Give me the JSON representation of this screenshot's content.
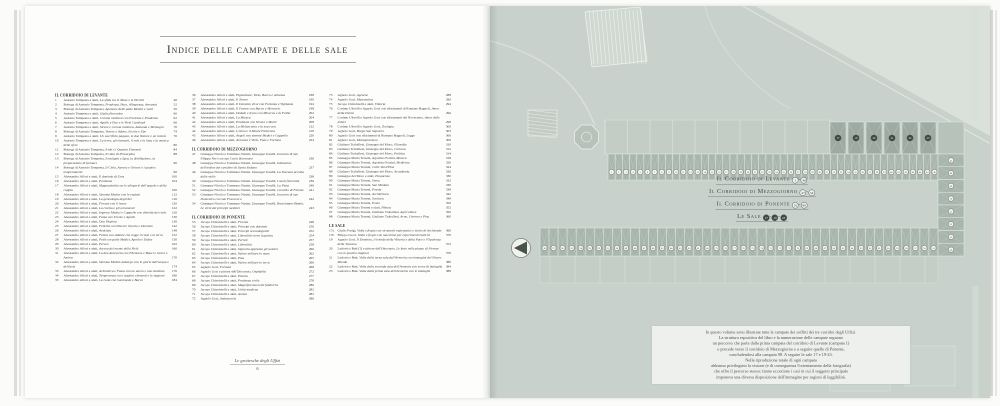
{
  "header": {
    "title": "Indice delle campate e delle sale"
  },
  "footer": {
    "book_title": "Le grottesche degli Uffizi",
    "page_number": "6"
  },
  "index": {
    "columns": [
      [
        {
          "h": "IL CORRIDOIO DI LEVANTE"
        },
        {
          "n": "1",
          "a": "Antonio Tempesta e aiuti,",
          "t": "La sfida tra le Muse e le Pieridi",
          "p": "46"
        },
        {
          "n": "2",
          "a": "Bottega di Antonio Tempesta,",
          "t": "Prudenza, Pace, Allegrezza, Armonia",
          "p": "52"
        },
        {
          "n": "3",
          "a": "Bottega di Antonio Tempesta,",
          "t": "Apoteosi delle palle Medici e venti",
          "p": "56"
        },
        {
          "n": "4",
          "a": "Antonio Tempesta e aiuti,",
          "t": "Giglio fiorentino",
          "p": "60"
        },
        {
          "n": "5",
          "a": "Antonio Tempesta e aiuti,",
          "t": "Corona medicea con Fortezza e Prudenza",
          "p": "62"
        },
        {
          "n": "6",
          "a": "Antonio Tempesta e aiuti,",
          "t": "Apollo e Pan e le Virtù Cardinali",
          "p": "66"
        },
        {
          "n": "7",
          "a": "Antonio Tempesta e aiuti,",
          "t": "Sirene e corona medicea, Atalanta e Meleagro",
          "p": "70"
        },
        {
          "n": "8",
          "a": "Bottega di Antonio Tempesta,",
          "t": "Venere e Adone, Ercole e Ebe",
          "p": "74"
        },
        {
          "n": "9",
          "a": "Antonio Tempesta e aiuti,",
          "t": "Un sacrificio pagano, le due Nature e un tralcio",
          "p": "76"
        },
        {
          "n": "10",
          "a": "Antonio Tempesta e aiuti,",
          "t": "La terra, gli elementi, il sole e la luna e la musica delle sfere",
          "p": "80"
        },
        {
          "n": "11",
          "a": "Bottega di Antonio Tempesta,",
          "t": "Iride e i Quattro Elementi",
          "p": "84"
        },
        {
          "n": "12",
          "a": "Bottega di Antonio Tempesta,",
          "t": "Il ratto di Proserpina",
          "p": "88"
        },
        {
          "n": "13",
          "a": "Bottega di Antonio Tempesta,",
          "t": "Esculapio e Igea, la distillazione, la preparazione di farmaci",
          "p": "90"
        },
        {
          "n": "14",
          "a": "Bottega di Antonio Tempesta,",
          "t": "Il Cielo, Aurora e Orione e i quattro temperamenti",
          "p": "96"
        },
        {
          "n": "15",
          "a": "Alessandro Allori e aiuti,",
          "t": "Il dominio di Eros",
          "p": "100"
        },
        {
          "n": "16",
          "a": "Alessandro Allori e aiuti,",
          "t": "Prudenza",
          "p": "104"
        },
        {
          "n": "17",
          "a": "Alessandro Allori e aiuti,",
          "t": "Magnanimità con le allegorie dell'angolo e della coppia",
          "p": "106"
        },
        {
          "n": "18",
          "a": "Alessandro Allori e aiuti,",
          "t": "Stemma Medici con le regioni",
          "p": "112"
        },
        {
          "n": "19",
          "a": "Alessandro Allori e aiuti,",
          "t": "La genealogia degli dei",
          "p": "116"
        },
        {
          "n": "20",
          "a": "Alessandro Allori e aiuti,",
          "t": "Firenze con il leone",
          "p": "120"
        },
        {
          "n": "21",
          "a": "Alessandro Allori e aiuti,",
          "t": "La civetta e gli ornamenti",
          "p": "122"
        },
        {
          "n": "22",
          "a": "Alessandro Allori e aiuti,",
          "t": "Imprese Medici e Cappello con divinità del cielo",
          "p": "126"
        },
        {
          "n": "23",
          "a": "Alessandro Allori e aiuti,",
          "t": "Fama con Ercole e Apollo",
          "p": "130"
        },
        {
          "n": "24",
          "a": "Alessandro Allori e aiuti,",
          "t": "Dea Virginia",
          "p": "136"
        },
        {
          "n": "25",
          "a": "Alessandro Allori e aiuti,",
          "t": "Felicità con Piacere Onesto e Dionisio",
          "p": "142"
        },
        {
          "n": "26",
          "a": "Alessandro Allori e aiuti,",
          "t": "Amicizia",
          "p": "148"
        },
        {
          "n": "27",
          "a": "Alessandro Allori e aiuti,",
          "t": "Fatica con Atlante che regge il cielo e la terra",
          "p": "152"
        },
        {
          "n": "28",
          "a": "Alessandro Allori e aiuti,",
          "t": "Putti con palle Medici, Apollo e Dafne",
          "p": "156"
        },
        {
          "n": "29",
          "a": "Alessandro Allori e aiuti,",
          "t": "Perseo",
          "p": "162"
        },
        {
          "n": "30",
          "a": "Alessandro Allori e aiuti,",
          "t": "Ascesa del monte della Virtù",
          "p": "166"
        },
        {
          "n": "31",
          "a": "Alessandro Allori e aiuti,",
          "t": "La dea Anteverta con Filemone e Bauci e Giove e Ambra",
          "p": "170"
        },
        {
          "n": "32",
          "a": "Alessandro Allori e aiuti,",
          "t": "Stemma Medici-Asburgo con le glorie dell'acqua e dell'aria",
          "p": "174"
        },
        {
          "n": "33",
          "a": "Alessandro Allori e aiuti,",
          "t": "Aritmetica e Fama con un aureo e uno studioso",
          "p": "176"
        },
        {
          "n": "34",
          "a": "Alessandro Allori e aiuti,",
          "t": "Temperanza con i quattro elementi e le stagioni",
          "p": "180"
        },
        {
          "n": "35",
          "a": "Alessandro Allori e aiuti,",
          "t": "La Gola con Ganimede e Bacco",
          "p": "184"
        }
      ],
      [
        {
          "n": "36",
          "a": "Alessandro Allori e aiuti,",
          "t": "Pigmalione, Tizio, Bacco e Arianna",
          "p": "188"
        },
        {
          "n": "37",
          "a": "Alessandro Allori e aiuti,",
          "t": "Il Tevere",
          "p": "190"
        },
        {
          "n": "38",
          "a": "Alessandro Allori e aiuti,",
          "t": "Il Dominio di sé con Fortezza e Vigilanza",
          "p": "194"
        },
        {
          "n": "39",
          "a": "Alessandro Allori e aiuti,",
          "t": "Il Favore con Bacco e Mercurio",
          "p": "198"
        },
        {
          "n": "40",
          "a": "Alessandro Allori e aiuti,",
          "t": "Dedalo e Icaro con Minerva e la Follia",
          "p": "202"
        },
        {
          "n": "41",
          "a": "Alessandro Allori e aiuti,",
          "t": "La Musica",
          "p": "204"
        },
        {
          "n": "42",
          "a": "Alessandro Allori e aiuti,",
          "t": "Prudenza con Venere e Marte",
          "p": "208"
        },
        {
          "n": "43",
          "a": "Alessandro Allori e aiuti,",
          "t": "La Melanconia e la sua cura",
          "p": "212"
        },
        {
          "n": "44",
          "a": "Alessandro Allori e aiuti,",
          "t": "L'Arno e il Monte Falterona",
          "p": "219"
        },
        {
          "n": "45",
          "a": "Alessandro Allori e aiuti,",
          "t": "Angeli con stemmi Medici e Cappello",
          "p": "220"
        },
        {
          "n": "46",
          "a": "Alessandro Allori e aiuti,",
          "t": "Armonia e Virtù, Fato e Fortuna",
          "p": "224"
        },
        {
          "h": "IL CORRIDOIO DI MEZZOGIORNO"
        },
        {
          "n": "47",
          "a": "Giuseppe Nicola e Tommaso Nasini, Giuseppe Tonelli,",
          "t": "Incontro di san Filippo Neri con san Carlo Borromeo",
          "p": "236"
        },
        {
          "n": "48",
          "a": "Giuseppe Nicola e Tommaso Nasini, Giuseppe Tonelli,",
          "t": "Istituzione dell'ordine dei cavalieri di Santo Stefano",
          "p": "237"
        },
        {
          "n": "49",
          "a": "Giuseppe Nicola e Tommaso Nasini, Giuseppe Tonelli,",
          "t": "La Toscana accolta dalle stelle",
          "p": "238"
        },
        {
          "n": "50",
          "a": "Giuseppe Nicola e Tommaso Nasini, Giuseppe Tonelli,",
          "t": "I santi fiorentini",
          "p": "239"
        },
        {
          "n": "51",
          "a": "Giuseppe Nicola e Tommaso Nasini, Giuseppe Tonelli,",
          "t": "La Pietà",
          "p": "240"
        },
        {
          "n": "52",
          "a": "Giuseppe Nicola e Tommaso Nasini, Giuseppe Tonelli,",
          "t": "Concilio di Firenze",
          "p": "241"
        },
        {
          "n": "53",
          "a": "Giuseppe Nicola e Tommaso Nasini, Giuseppe Tonelli,",
          "t": "Incontro di san Domenico con san Francesco",
          "p": "242"
        },
        {
          "n": "54",
          "a": "Giuseppe Nicola e Tommaso Nasini, Giuseppe Tonelli, Bartolomeo Bimbi,",
          "t": "Le virtù dei principi medicei",
          "p": "243"
        },
        {
          "h": "IL CORRIDOIO DI PONENTE"
        },
        {
          "n": "55",
          "a": "Jacopo Chiavistelli e aiuti,",
          "t": "Firenze",
          "p": "248"
        },
        {
          "n": "56",
          "a": "Jacopo Chiavistelli e aiuti,",
          "t": "Principi con dominio",
          "p": "250"
        },
        {
          "n": "57",
          "a": "Jacopo Chiavistelli e aiuti,",
          "t": "Principi secondogeniti",
          "p": "252"
        },
        {
          "n": "58",
          "a": "Jacopo Chiavistelli e aiuti,",
          "t": "Liberalità verso la patria",
          "p": "254"
        },
        {
          "n": "59",
          "a": "Jacopo Chiavistelli e aiuti,",
          "t": "Pericle",
          "p": "257"
        },
        {
          "n": "60",
          "a": "Jacopo Chiavistelli e aiuti,",
          "t": "Liberalità",
          "p": "258"
        },
        {
          "n": "61",
          "a": "Jacopo Chiavistelli e aiuti,",
          "t": "Signoria apprezza gli uomini",
          "p": "260"
        },
        {
          "n": "62",
          "a": "Jacopo Chiavistelli e aiuti,",
          "t": "Valore militare in mare",
          "p": "262"
        },
        {
          "n": "63",
          "a": "Jacopo Chiavistelli e aiuti,",
          "t": "Pisa",
          "p": "265"
        },
        {
          "n": "64",
          "a": "Jacopo Chiavistelli e aiuti,",
          "t": "Valore militare in terra",
          "p": "266"
        },
        {
          "n": "65",
          "a": "Agnolo Gori,",
          "t": "Fortuna",
          "p": "268"
        },
        {
          "n": "66",
          "a": "Agnolo Gori e pittore dell'Ottocento,",
          "t": "Ospitalità",
          "p": "272"
        },
        {
          "n": "67",
          "a": "Jacopo Chiavistelli e aiuti,",
          "t": "Pistoia",
          "p": "277"
        },
        {
          "n": "68",
          "a": "Jacopo Chiavistelli e aiuti,",
          "t": "Prudenza civile",
          "p": "278"
        },
        {
          "n": "69",
          "a": "Jacopo Chiavistelli e aiuti,",
          "t": "Magnificenza nelle fabbriche",
          "p": "280"
        },
        {
          "n": "70",
          "a": "Jacopo Chiavistelli e aiuti,",
          "t": "Unità medicea",
          "p": "282"
        },
        {
          "n": "71",
          "a": "Jacopo Chiavistelli e aiuti,",
          "t": "Arezzo",
          "p": "285"
        },
        {
          "n": "72",
          "a": "Agnolo Gori,",
          "t": "Ambasceria",
          "p": "286"
        }
      ],
      [
        {
          "n": "73",
          "a": "Agnolo Gori,",
          "t": "Agraria",
          "p": "288"
        },
        {
          "n": "74",
          "a": "Agnolo Gori,",
          "t": "Matematica",
          "p": "290"
        },
        {
          "n": "75",
          "a": "Jacopo Chiavistelli e aiuti,",
          "t": "Vittoria",
          "p": "294"
        },
        {
          "n": "76",
          "a": "Cosimo Ulivelli e Agnolo Gori con rifacimenti di Romano Bagnoli,",
          "t": "Amor della Patria",
          "p": "296"
        },
        {
          "n": "77",
          "a": "Cosimo Ulivelli e Agnolo Gori con rifacimenti del Novecento,",
          "t": "Amor delle lettere",
          "p": "298"
        },
        {
          "n": "78",
          "a": "Cosimo Ulivelli e Agnolo Gori,",
          "t": "Teologia",
          "p": "300"
        },
        {
          "n": "79",
          "a": "Agnolo Gori,",
          "t": "Borgo San Sepolcro",
          "p": "303"
        },
        {
          "n": "80",
          "a": "Agnolo Gori con rifacimenti di Romano Bagnoli,",
          "t": "Legge",
          "p": "306"
        },
        {
          "n": "81",
          "a": "Agnolo Gori,",
          "t": "Montepulciano",
          "p": "309"
        },
        {
          "n": "82",
          "a": "Giuliano Traballesi, Giuseppe del Moro,",
          "t": "Filosofia",
          "p": "310"
        },
        {
          "n": "83",
          "a": "Giuliano Traballesi, Giuseppe del Moro,",
          "t": "Cortona",
          "p": "312"
        },
        {
          "n": "84",
          "a": "Giuliano Traballesi, Giuseppe del Moro,",
          "t": "Politica",
          "p": "314"
        },
        {
          "n": "85",
          "a": "Giuseppe Maria Terreni, Agostino Fortini,",
          "t": "Musica",
          "p": "318"
        },
        {
          "n": "86",
          "a": "Giuseppe Maria Terreni, Agostino Fortini,",
          "t": "Medicina",
          "p": "320"
        },
        {
          "n": "87",
          "a": "Giuseppe Maria Terreni,",
          "t": "Colle Val d'Elsa",
          "p": "324"
        },
        {
          "n": "88",
          "a": "Giuliano Traballesi, Giuseppe del Moro,",
          "t": "Accademia",
          "p": "326"
        },
        {
          "n": "89",
          "a": "Giuseppe del Moro e aiuti,",
          "t": "Eloquenza",
          "p": "330"
        },
        {
          "n": "90",
          "a": "Giuseppe Maria Terreni,",
          "t": "Siena",
          "p": "332"
        },
        {
          "n": "91",
          "a": "Giuseppe Maria Terreni,",
          "t": "San Miniato",
          "p": "336"
        },
        {
          "n": "92",
          "a": "Giuseppe Maria Terreni,",
          "t": "Poesia",
          "p": "338"
        },
        {
          "n": "93",
          "a": "Giuseppe Maria Terreni,",
          "t": "Architettura",
          "p": "342"
        },
        {
          "n": "94",
          "a": "Giuseppe Maria Terreni,",
          "t": "Scultura",
          "p": "346"
        },
        {
          "n": "95",
          "a": "Giuseppe Maria Terreni,",
          "t": "Prato",
          "p": "350"
        },
        {
          "n": "96",
          "a": "Giuseppe Maria Terreni e aiuti,",
          "t": "Pittura",
          "p": "352"
        },
        {
          "n": "97",
          "a": "Giuseppe Maria Terreni, Giuliano Traballesi,",
          "t": "Agricoltura",
          "p": "356"
        },
        {
          "n": "98",
          "a": "Giuseppe Maria Terreni, Giuliano Traballesi,",
          "t": "Arno, Livorno e Pisa",
          "p": "360"
        },
        {
          "h": "LE SALE"
        },
        {
          "n": "17a",
          "a": "Giulio Parigi,",
          "t": "Volta e fregio con strumenti matematici e storie di Archimede",
          "p": "366"
        },
        {
          "n": "17b",
          "a": "Filippo Lucci,",
          "t": "Volta e fregio con macchine per esperimenti elettrici",
          "p": "370"
        },
        {
          "n": "19",
          "a": "Agnolo Gori,",
          "t": "Il Dominio, il trionfo della Vittoria e della Pace e l'Opulenza della Toscana",
          "p": "372"
        },
        {
          "n": "20",
          "a": "Ludovico Buti (?) e pittore dell'Ottocento,",
          "t": "Le feste nelle piazze di Firenze con le quattro stagioni",
          "p": "376"
        },
        {
          "n": "21",
          "a": "Ludovico Buti,",
          "t": "Volta della terza sala dell'Armeria con immagini del Nuovo Mondo",
          "p": "380"
        },
        {
          "n": "22",
          "a": "Ludovico Buti,",
          "t": "Volta della seconda sala dell'Armeria con scene di battaglia",
          "p": "384"
        },
        {
          "n": "23",
          "a": "Ludovico Buti,",
          "t": "Volta della prima sala dell'Armeria con le battaglie",
          "p": "388"
        }
      ]
    ]
  },
  "map": {
    "legend": [
      {
        "label": "Il Corridoio di Levante",
        "markers": [
          "1",
          "46"
        ],
        "style": "outline"
      },
      {
        "label": "Il Corridoio di Mezzogiorno",
        "markers": [
          "47",
          "54"
        ],
        "style": "outline"
      },
      {
        "label": "Il Corridoio di Ponente",
        "markers": [
          "55",
          "98"
        ],
        "style": "outline"
      },
      {
        "label": "Le Sale",
        "markers": [
          "17",
          "19",
          "23"
        ],
        "style": "filled"
      }
    ],
    "corridors": {
      "levante": {
        "from": 1,
        "to": 46
      },
      "mezzogiorno": {
        "from": 47,
        "to": 54
      },
      "ponente": {
        "from": 55,
        "to": 98
      }
    },
    "sale_labels": [
      "17",
      "19",
      "20",
      "21",
      "22",
      "23"
    ],
    "colors": {
      "background": "#c8d1cb",
      "bay": "#a9b6ae",
      "bay_stroke": "#e6ebe6",
      "circle_fill": "#f6f7f5",
      "circle_stroke": "#5d6b63",
      "sala_dot": "#3e4a43",
      "legend_text": "#414f48",
      "street": "#dde3dd"
    },
    "caption_lines": [
      "In questo volume sono illustrate tutte le campate dei soffitti dei tre corridoi degli Uffizi.",
      "La struttura espositiva del libro e la numerazione delle campate seguono",
      "un percorso che parte dalla prima campata del corridoio di Levante (campata 1)",
      "e procede verso il corridoio di Mezzogiorno e a seguire quello di Ponente,",
      "concludendosi alla campata 98. A seguire le sale 17 e 19-23.",
      "Nella riproduzione totale di ogni campata",
      "abbiamo privilegiato la visione (e di conseguenza l'orientamento della fotografia)",
      "che offre il percorso stesso; fanno eccezione i casi in cui il soggetto principale",
      "imponeva una diversa disposizione dell'immagine per ragioni di leggibilità."
    ]
  }
}
